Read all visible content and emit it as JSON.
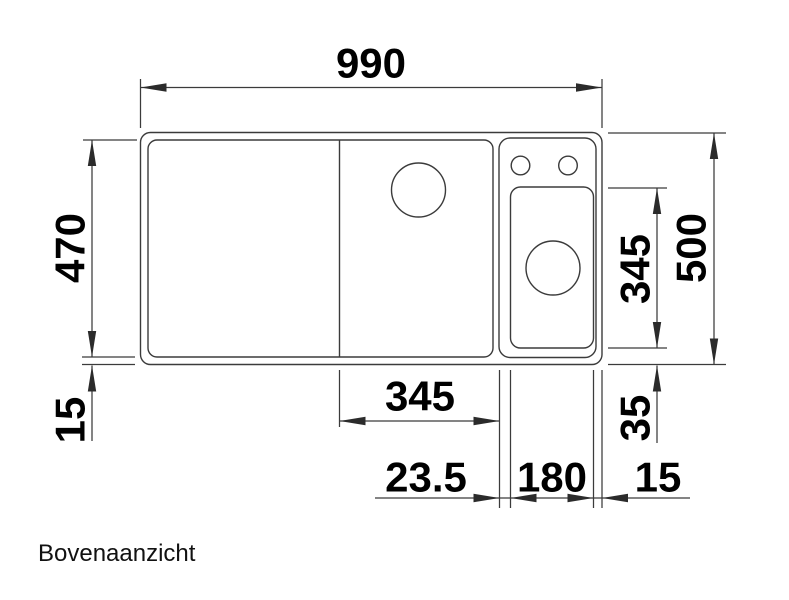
{
  "view": {
    "label": "Bovenaanzicht"
  },
  "dims": {
    "total_width": "990",
    "inner_depth": "470",
    "front_rim": "15",
    "total_depth": "500",
    "half_bowl_depth": "345",
    "half_bowl_front_rim": "35",
    "main_bowl_width": "345",
    "bowl_gap": "23.5",
    "half_bowl_width": "180",
    "right_rim": "15"
  },
  "style": {
    "line_color": "#3b3b3b",
    "text_color": "#000000",
    "background": "#ffffff"
  }
}
